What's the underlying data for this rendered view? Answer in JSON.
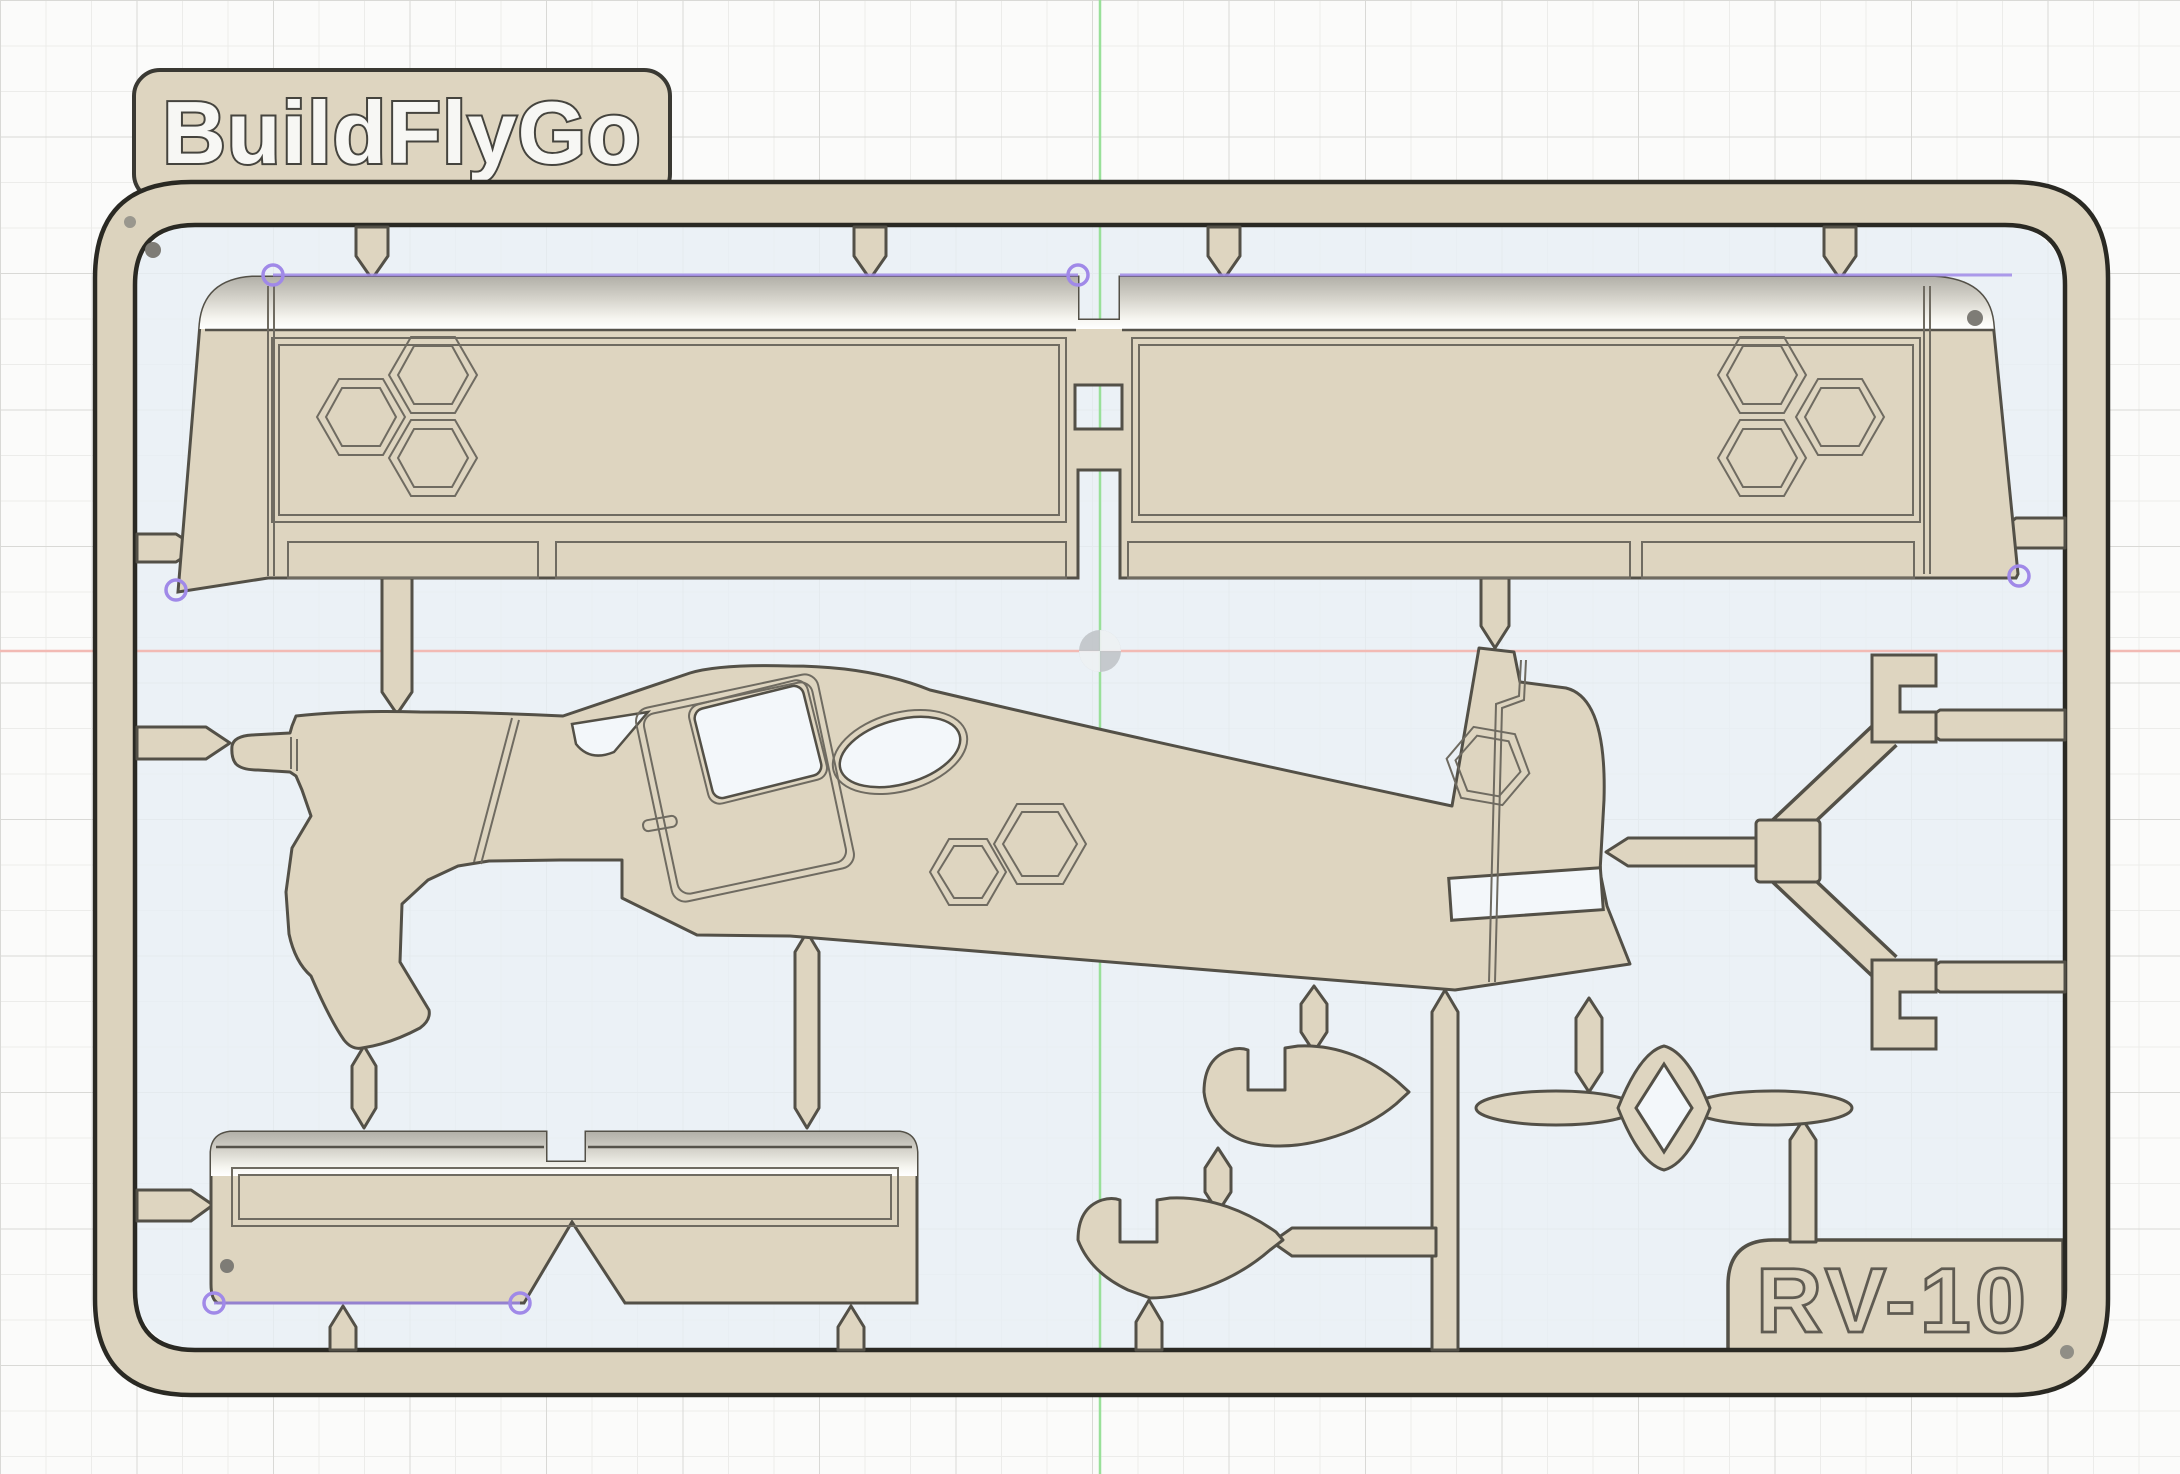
{
  "labels": {
    "brand": "BuildFlyGo",
    "model": "RV-10"
  },
  "canvas": {
    "width": 2180,
    "height": 1474,
    "outside_background": "#fbfbfa",
    "grid_minor_color": "#ececea",
    "grid_major_color": "#d9d9d6",
    "grid_minor_step": 45.5,
    "grid_major_step": 136.5
  },
  "sketch_plane": {
    "fill": "#e7eef5",
    "origin_icon": "origin-quadrant-icon",
    "origin_x": 1100,
    "origin_y": 651,
    "x_axis_color": "#f2bab4",
    "y_axis_color": "#99e099"
  },
  "sprue": {
    "plastic_color": "#ded5c0",
    "part_outline_color": "#535047",
    "frame_outline_color": "#2a2923",
    "engraving_color": "#6f6b61",
    "hole_fill": "#f3f7fa",
    "bevel_highlight": "#ffffff"
  },
  "markers": {
    "constraint_color": "#a089e8",
    "vertex_dot_color": "#7e7c76",
    "constraint_circle_count": 8,
    "vertex_dot_count": 5
  },
  "parts": [
    "wing-panel-pair",
    "fuselage-side-profile",
    "horizontal-stabilizer-panel",
    "nose-gear-fairing",
    "main-wheel-pant-upper",
    "main-wheel-pant-lower",
    "landing-gear-legs",
    "propeller",
    "rudder-base-wedge"
  ]
}
